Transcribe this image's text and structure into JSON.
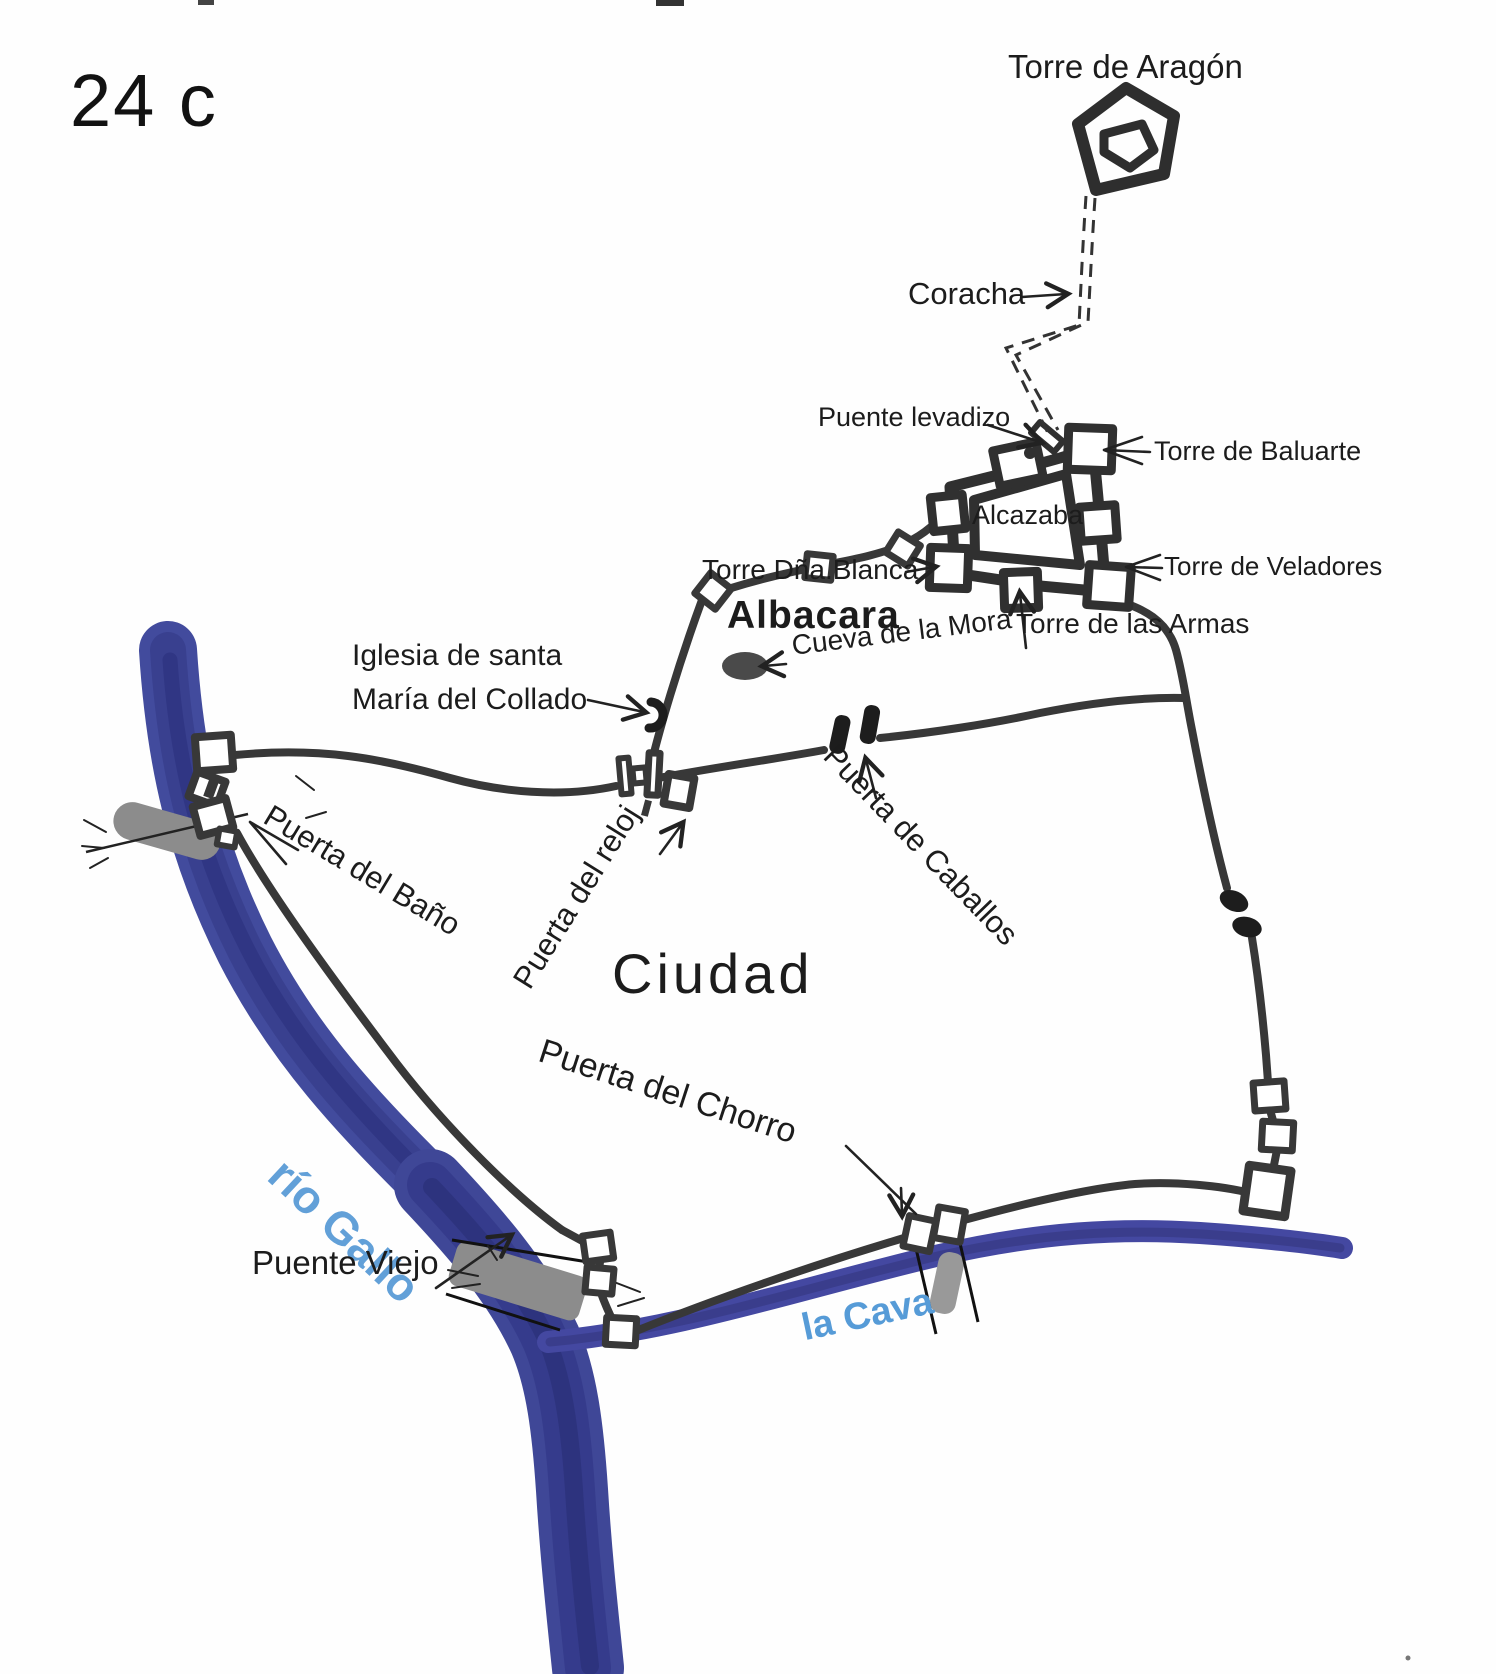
{
  "map": {
    "figure_label": "24 c",
    "landmarks": {
      "torre_de_aragon": "Torre de Aragón",
      "coracha": "Coracha",
      "puente_levadizo": "Puente levadizo",
      "torre_de_baluarte": "Torre de Baluarte",
      "alcazaba": "Alcazaba",
      "torre_dna_blanca": "Torre Dña.Blanca",
      "torre_de_veladores": "Torre de Veladores",
      "torre_de_las_armas": "Torre de las Armas",
      "albacara": "Albacara",
      "cueva_de_la_mora": "Cueva de la Mora",
      "iglesia_line1": "Iglesia de santa",
      "iglesia_line2": "María del Collado",
      "puerta_del_bano": "Puerta del Baño",
      "puerta_del_reloj": "Puerta del reloj",
      "puerta_de_caballos": "Puerta de Caballos",
      "ciudad": "Ciudad",
      "puerta_del_chorro": "Puerta del Chorro",
      "rio_gallo": "río Gallo",
      "puente_viejo": "Puente Viejo",
      "la_cava": "la Cava"
    },
    "icons": {
      "torre_de_aragon_tower": "double-pentagon outline",
      "church_symbol": "open horseshoe arc",
      "cueva_symbol": "filled dark ellipse",
      "bridge_symbol": "gray bar across water",
      "gate_symbol": "paired wall towers",
      "coracha_line": "double dashed line"
    },
    "colors": {
      "ink": "#383838",
      "text_black": "#1c1c1c",
      "river_blue": "#414a9c",
      "river_core": "#2d3380",
      "cava_blue": "#4448a1",
      "bridge_gray": "#8c8c8c",
      "water_label_blue": "#5f9fd8",
      "cueva_fill": "#4a4a4a"
    }
  }
}
